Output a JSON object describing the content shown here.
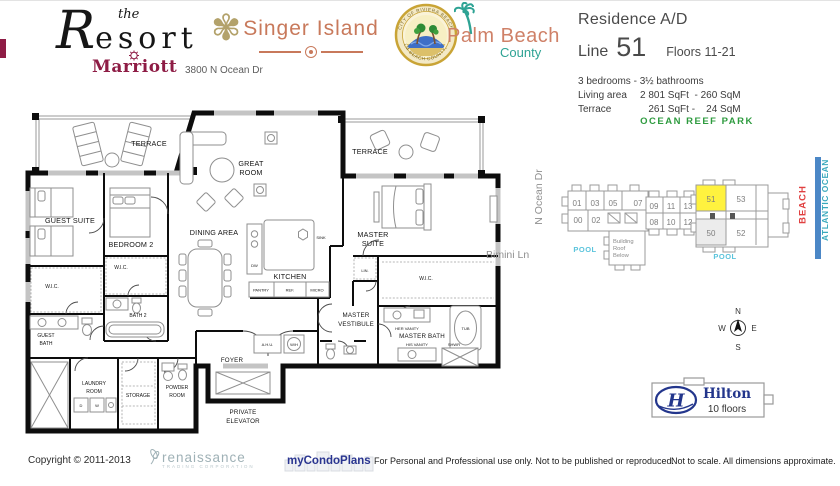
{
  "header": {
    "the": "the",
    "resort": "Resort",
    "marriott": "Marriott",
    "address": "3800 N Ocean Dr",
    "singer_island": "Singer Island",
    "seal_top": "CITY OF RIVIERA BEACH",
    "seal_bottom": "PALM BEACH COUNTY, FL.",
    "palm_beach": "Palm Beach",
    "county": "County",
    "residence": "Residence A/D",
    "line_label": "Line",
    "line_number": "51",
    "floors": "Floors 11-21",
    "bed_bath": "3 bedrooms - 3½ bathrooms",
    "living_label": "Living area",
    "living_value": "2 801 SqFt  - 260 SqM",
    "terrace_label": "Terrace",
    "terrace_value": "   261 SqFt -    24 SqM"
  },
  "plan": {
    "terrace_left": "TERRACE",
    "terrace_right": "TERRACE",
    "great_room_1": "GREAT",
    "great_room_2": "ROOM",
    "guest_suite": "GUEST SUITE",
    "bedroom2": "BEDROOM 2",
    "dining_area": "DINING AREA",
    "master_suite_1": "MASTER",
    "master_suite_2": "SUITE",
    "kitchen": "KITCHEN",
    "sink": "SINK",
    "dw": "DW",
    "ref": "REF.",
    "micro": "MICRO",
    "pantry": "PANTRY",
    "lin": "LIN.",
    "wic_guest": "W.I.C.",
    "wic_bedroom2": "W.I.C.",
    "wic_master": "W.I.C.",
    "guest_bath_1": "GUEST",
    "guest_bath_2": "BATH",
    "bath2": "BATH 2",
    "laundry_1": "LAUNDRY",
    "laundry_2": "ROOM",
    "storage": "STORAGE",
    "powder_1": "POWDER",
    "powder_2": "ROOM",
    "foyer": "FOYER",
    "private_elevator_1": "PRIVATE",
    "private_elevator_2": "ELEVATOR",
    "master_vestibule_1": "MASTER",
    "master_vestibule_2": "VESTIBULE",
    "master_bath": "MASTER BATH",
    "her_vanity": "HER VANITY",
    "his_vanity": "HIS VANITY",
    "tub": "TUB",
    "shwr": "SHWR",
    "ahu": "A.H.U.",
    "wh": "W/H",
    "dryer": "D",
    "washer": "W"
  },
  "siteplan": {
    "park": "OCEAN REEF PARK",
    "units": {
      "u00": "00",
      "u01": "01",
      "u02": "02",
      "u03": "03",
      "u05": "05",
      "u07": "07",
      "u08": "08",
      "u09": "09",
      "u10": "10",
      "u11": "11",
      "u12": "12",
      "u13": "13",
      "u50": "50",
      "u51": "51",
      "u52": "52",
      "u53": "53"
    },
    "building_roof_1": "Building",
    "building_roof_2": "Roof",
    "building_roof_3": "Below",
    "pool_left": "POOL",
    "pool_right": "POOL",
    "beach": "BEACH",
    "ocean": "ATLANTIC OCEAN",
    "n_ocean_dr": "N Ocean Dr",
    "bimini_ln": "Bimini Ln"
  },
  "compass": {
    "n": "N",
    "e": "E",
    "s": "S",
    "w": "W"
  },
  "hilton": {
    "name": "Hilton",
    "h": "H",
    "floors": "10 floors"
  },
  "footer": {
    "copyright": "Copyright © 2011-2013",
    "renaissance": "renaissance",
    "renaissance_sub": "TRADING CORPORATION",
    "brand": "myCondoPlans",
    "disclaimer": "For Personal and Professional use only.  Not to be published or reproduced.",
    "scale": "Not to scale.  All dimensions approximate."
  },
  "colors": {
    "marriott_red": "#8E1C45",
    "singer_coral": "#C8795B",
    "palm_coral": "#CF8168",
    "palm_teal": "#2EA394",
    "park_green": "#2E9B3F",
    "pool_cyan": "#5BC4DC",
    "beach_red": "#E04040",
    "ocean_teal": "#39A9BC",
    "ocean_bar_blue": "#4B87C6",
    "highlight_yellow": "#FFF23F",
    "hilton_navy": "#23368C",
    "brand_navy": "#2A3590",
    "renaissance_gray": "#9FB1B6",
    "road_gray": "#8F8F8F"
  }
}
